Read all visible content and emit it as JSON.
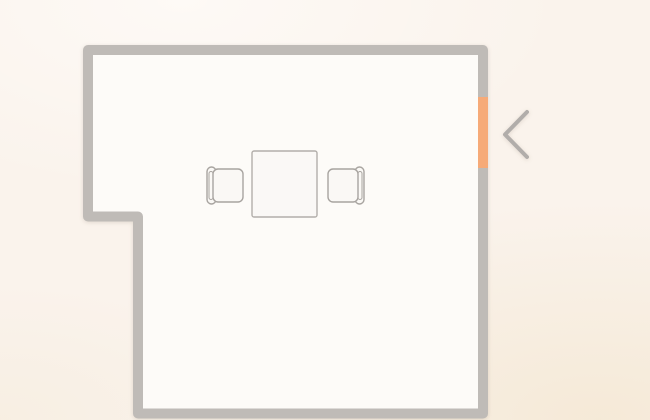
{
  "app": {
    "type": "floor-plan-editor-canvas"
  },
  "colors": {
    "background": "#faf3ec",
    "room_floor": "#fdfbf8",
    "wall": "#bfbbb7",
    "door_accent": "#f6aa78",
    "chevron": "#b1adaa",
    "furniture_fill": "#faf8f5",
    "furniture_stroke": "#a8a4a0",
    "table_fill": "#faf8f6",
    "table_stroke": "#b2aeaa"
  },
  "floorplan": {
    "canvas": {
      "width": 650,
      "height": 420
    },
    "wall_thickness": 10,
    "room_centerline_points": [
      [
        88,
        50
      ],
      [
        483,
        50
      ],
      [
        483,
        413.5
      ],
      [
        138,
        413.5
      ],
      [
        138,
        216.5
      ],
      [
        88,
        216.5
      ]
    ],
    "door": {
      "wall": "right",
      "x": 478,
      "y": 97,
      "width": 10,
      "height": 71
    },
    "table": {
      "x": 252,
      "y": 151,
      "width": 65,
      "height": 66,
      "corner_radius": 2
    },
    "chairs": [
      {
        "id": "chair-left",
        "facing": "right",
        "seat": {
          "x": 213,
          "y": 169,
          "width": 30,
          "height": 33,
          "corner_radius": 5
        },
        "backrest": {
          "x": 207,
          "y": 167,
          "width": 9,
          "height": 37,
          "corner_radius": 4.5
        },
        "backrest_inner": {
          "x": 209,
          "y": 171.5,
          "width": 4,
          "height": 28,
          "corner_radius": 2
        }
      },
      {
        "id": "chair-right",
        "facing": "left",
        "seat": {
          "x": 328,
          "y": 169,
          "width": 30,
          "height": 33,
          "corner_radius": 5
        },
        "backrest": {
          "x": 355,
          "y": 167,
          "width": 9,
          "height": 37,
          "corner_radius": 4.5
        },
        "backrest_inner": {
          "x": 358,
          "y": 171.5,
          "width": 4,
          "height": 28,
          "corner_radius": 2
        }
      }
    ],
    "chevron_control": {
      "direction": "left",
      "points": [
        [
          527,
          112
        ],
        [
          505,
          134.5
        ],
        [
          527,
          157
        ]
      ],
      "stroke_width": 4
    }
  }
}
